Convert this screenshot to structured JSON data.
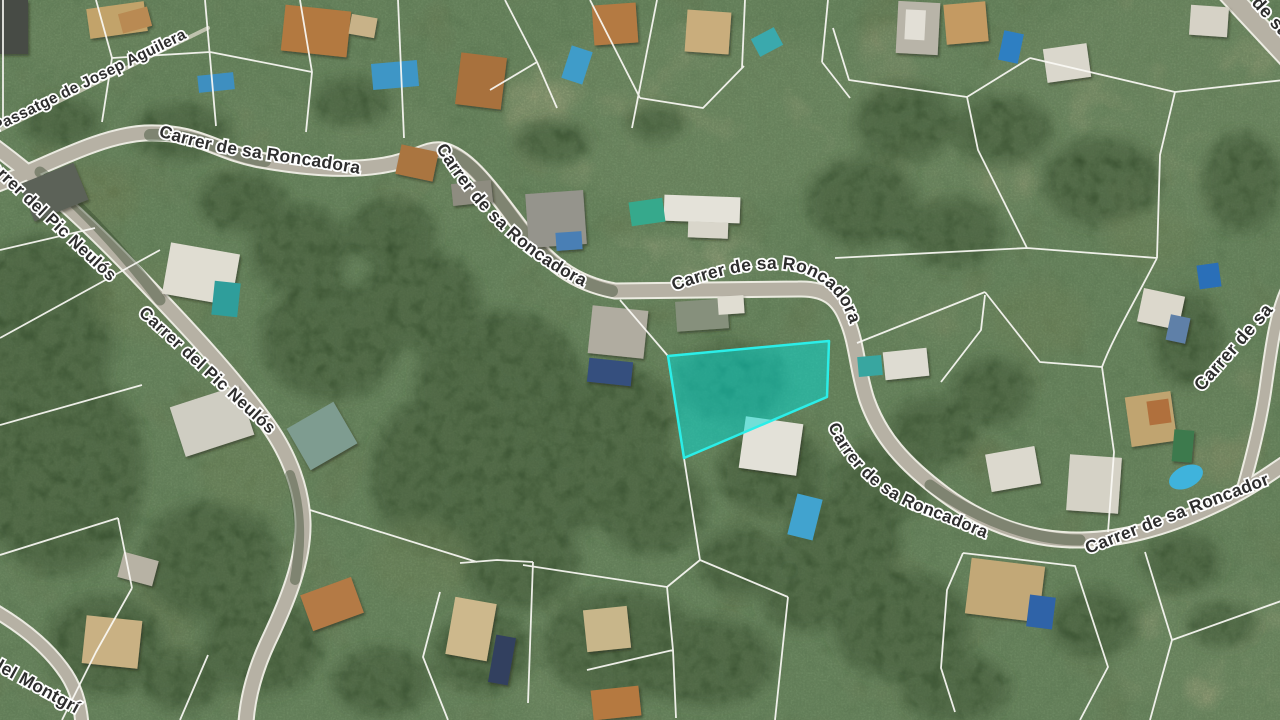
{
  "map": {
    "kind": "satellite-cadastral-view",
    "street_labels": [
      {
        "id": "passatge-josep-aguilera",
        "text": "Passatge de Josep Aguilera"
      },
      {
        "id": "roncadora-top",
        "text": "Carrer de sa Roncadora"
      },
      {
        "id": "roncadora-diagonal",
        "text": "Carrer de sa Roncadora"
      },
      {
        "id": "roncadora-center",
        "text": "Carrer de sa Roncadora"
      },
      {
        "id": "pic-neulos-upper",
        "text": "Carrer del Pic Neulós"
      },
      {
        "id": "pic-neulos-lower",
        "text": "Carrer del Pic Neulós"
      },
      {
        "id": "roncadora-parcel-curve",
        "text": "Carrer de sa Roncadora"
      },
      {
        "id": "roncadora-bottom-right",
        "text": "Carrer de sa Roncadora"
      },
      {
        "id": "roncadora-right-edge",
        "text": "Carrer de sa"
      },
      {
        "id": "roncadora-top-right",
        "text": "Carrer de sa Roncadora"
      },
      {
        "id": "montgri",
        "text": "Carrer del Montgrí"
      }
    ],
    "highlighted_parcel": {
      "points": "668,356 829,341 827,397 684,458",
      "fill": "#00ded6",
      "fill_opacity": "0.5",
      "stroke": "#2beee8",
      "stroke_width": "2.5"
    }
  }
}
